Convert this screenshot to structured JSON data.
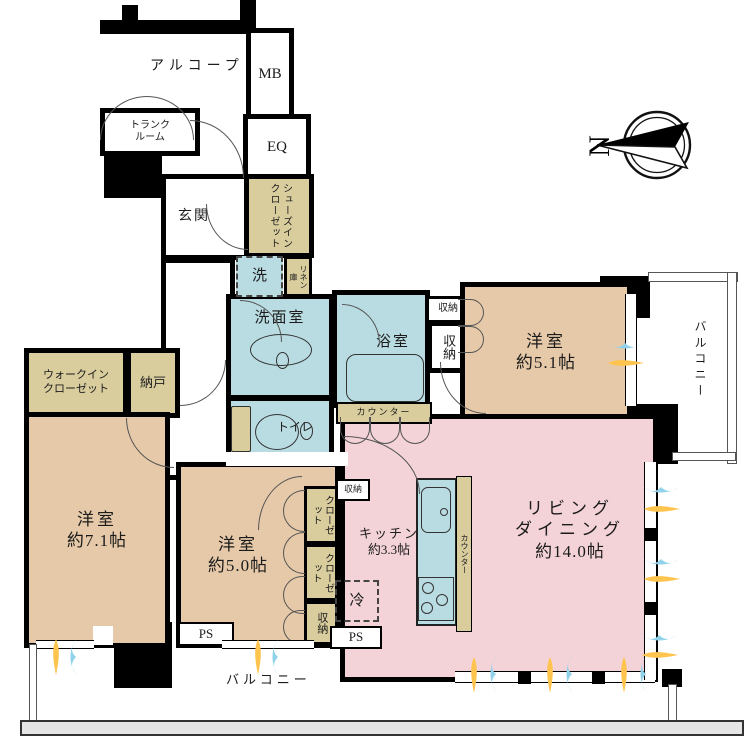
{
  "meta": {
    "type": "apartment-floorplan",
    "area_unit": "帖"
  },
  "colors": {
    "room_tan": "#e6c9a8",
    "wet_blue": "#b9dce2",
    "living_pink": "#f3d3d8",
    "closet_beige": "#d9cd9e",
    "vent_orange": "#ffc44d",
    "vent_blue": "#8fd2ea"
  },
  "rooms": {
    "alcove": {
      "label": "アルコープ"
    },
    "mb": {
      "label": "MB"
    },
    "trunk": {
      "line1": "トランク",
      "line2": "ルーム"
    },
    "eq": {
      "label": "EQ"
    },
    "genkan": {
      "label": "玄関"
    },
    "shoes_closet": {
      "label": "シューズインクローゼット"
    },
    "washer": {
      "label": "洗"
    },
    "linen": {
      "label": "リネン庫"
    },
    "senmen": {
      "label": "洗面室"
    },
    "toilet": {
      "label": "トイレ"
    },
    "bath": {
      "label": "浴室"
    },
    "storage_a": {
      "label": "収納"
    },
    "storage_b": {
      "label": "収納"
    },
    "room51": {
      "label": "洋室",
      "size": "約5.1帖"
    },
    "balcony_right": {
      "label": "バルコニー"
    },
    "walkin": {
      "line1": "ウォークイン",
      "line2": "クローゼット"
    },
    "nando": {
      "label": "納戸"
    },
    "room71": {
      "label": "洋室",
      "size": "約7.1帖"
    },
    "room50": {
      "label": "洋室",
      "size": "約5.0帖"
    },
    "closet1": {
      "label": "クローゼット"
    },
    "closet2": {
      "label": "クローゼット"
    },
    "storage_c": {
      "label": "収納"
    },
    "kitchen": {
      "label": "キッチン",
      "size": "約3.3帖"
    },
    "fridge": {
      "label": "冷"
    },
    "counter_kitchen": {
      "label": "カウンター"
    },
    "counter_ld": {
      "label": "カウンター"
    },
    "storage_kitchen": {
      "label": "収納"
    },
    "living": {
      "line1": "リビング",
      "line2": "ダイニング",
      "size": "約14.0帖"
    },
    "ps1": {
      "label": "PS"
    },
    "ps2": {
      "label": "PS"
    },
    "balcony_bottom": {
      "label": "バルコニー"
    }
  },
  "compass": {
    "label": "N"
  },
  "icons": {
    "compass": "compass-north-icon",
    "vent_warm": "warm-air-icon",
    "vent_cool": "cool-air-icon"
  }
}
